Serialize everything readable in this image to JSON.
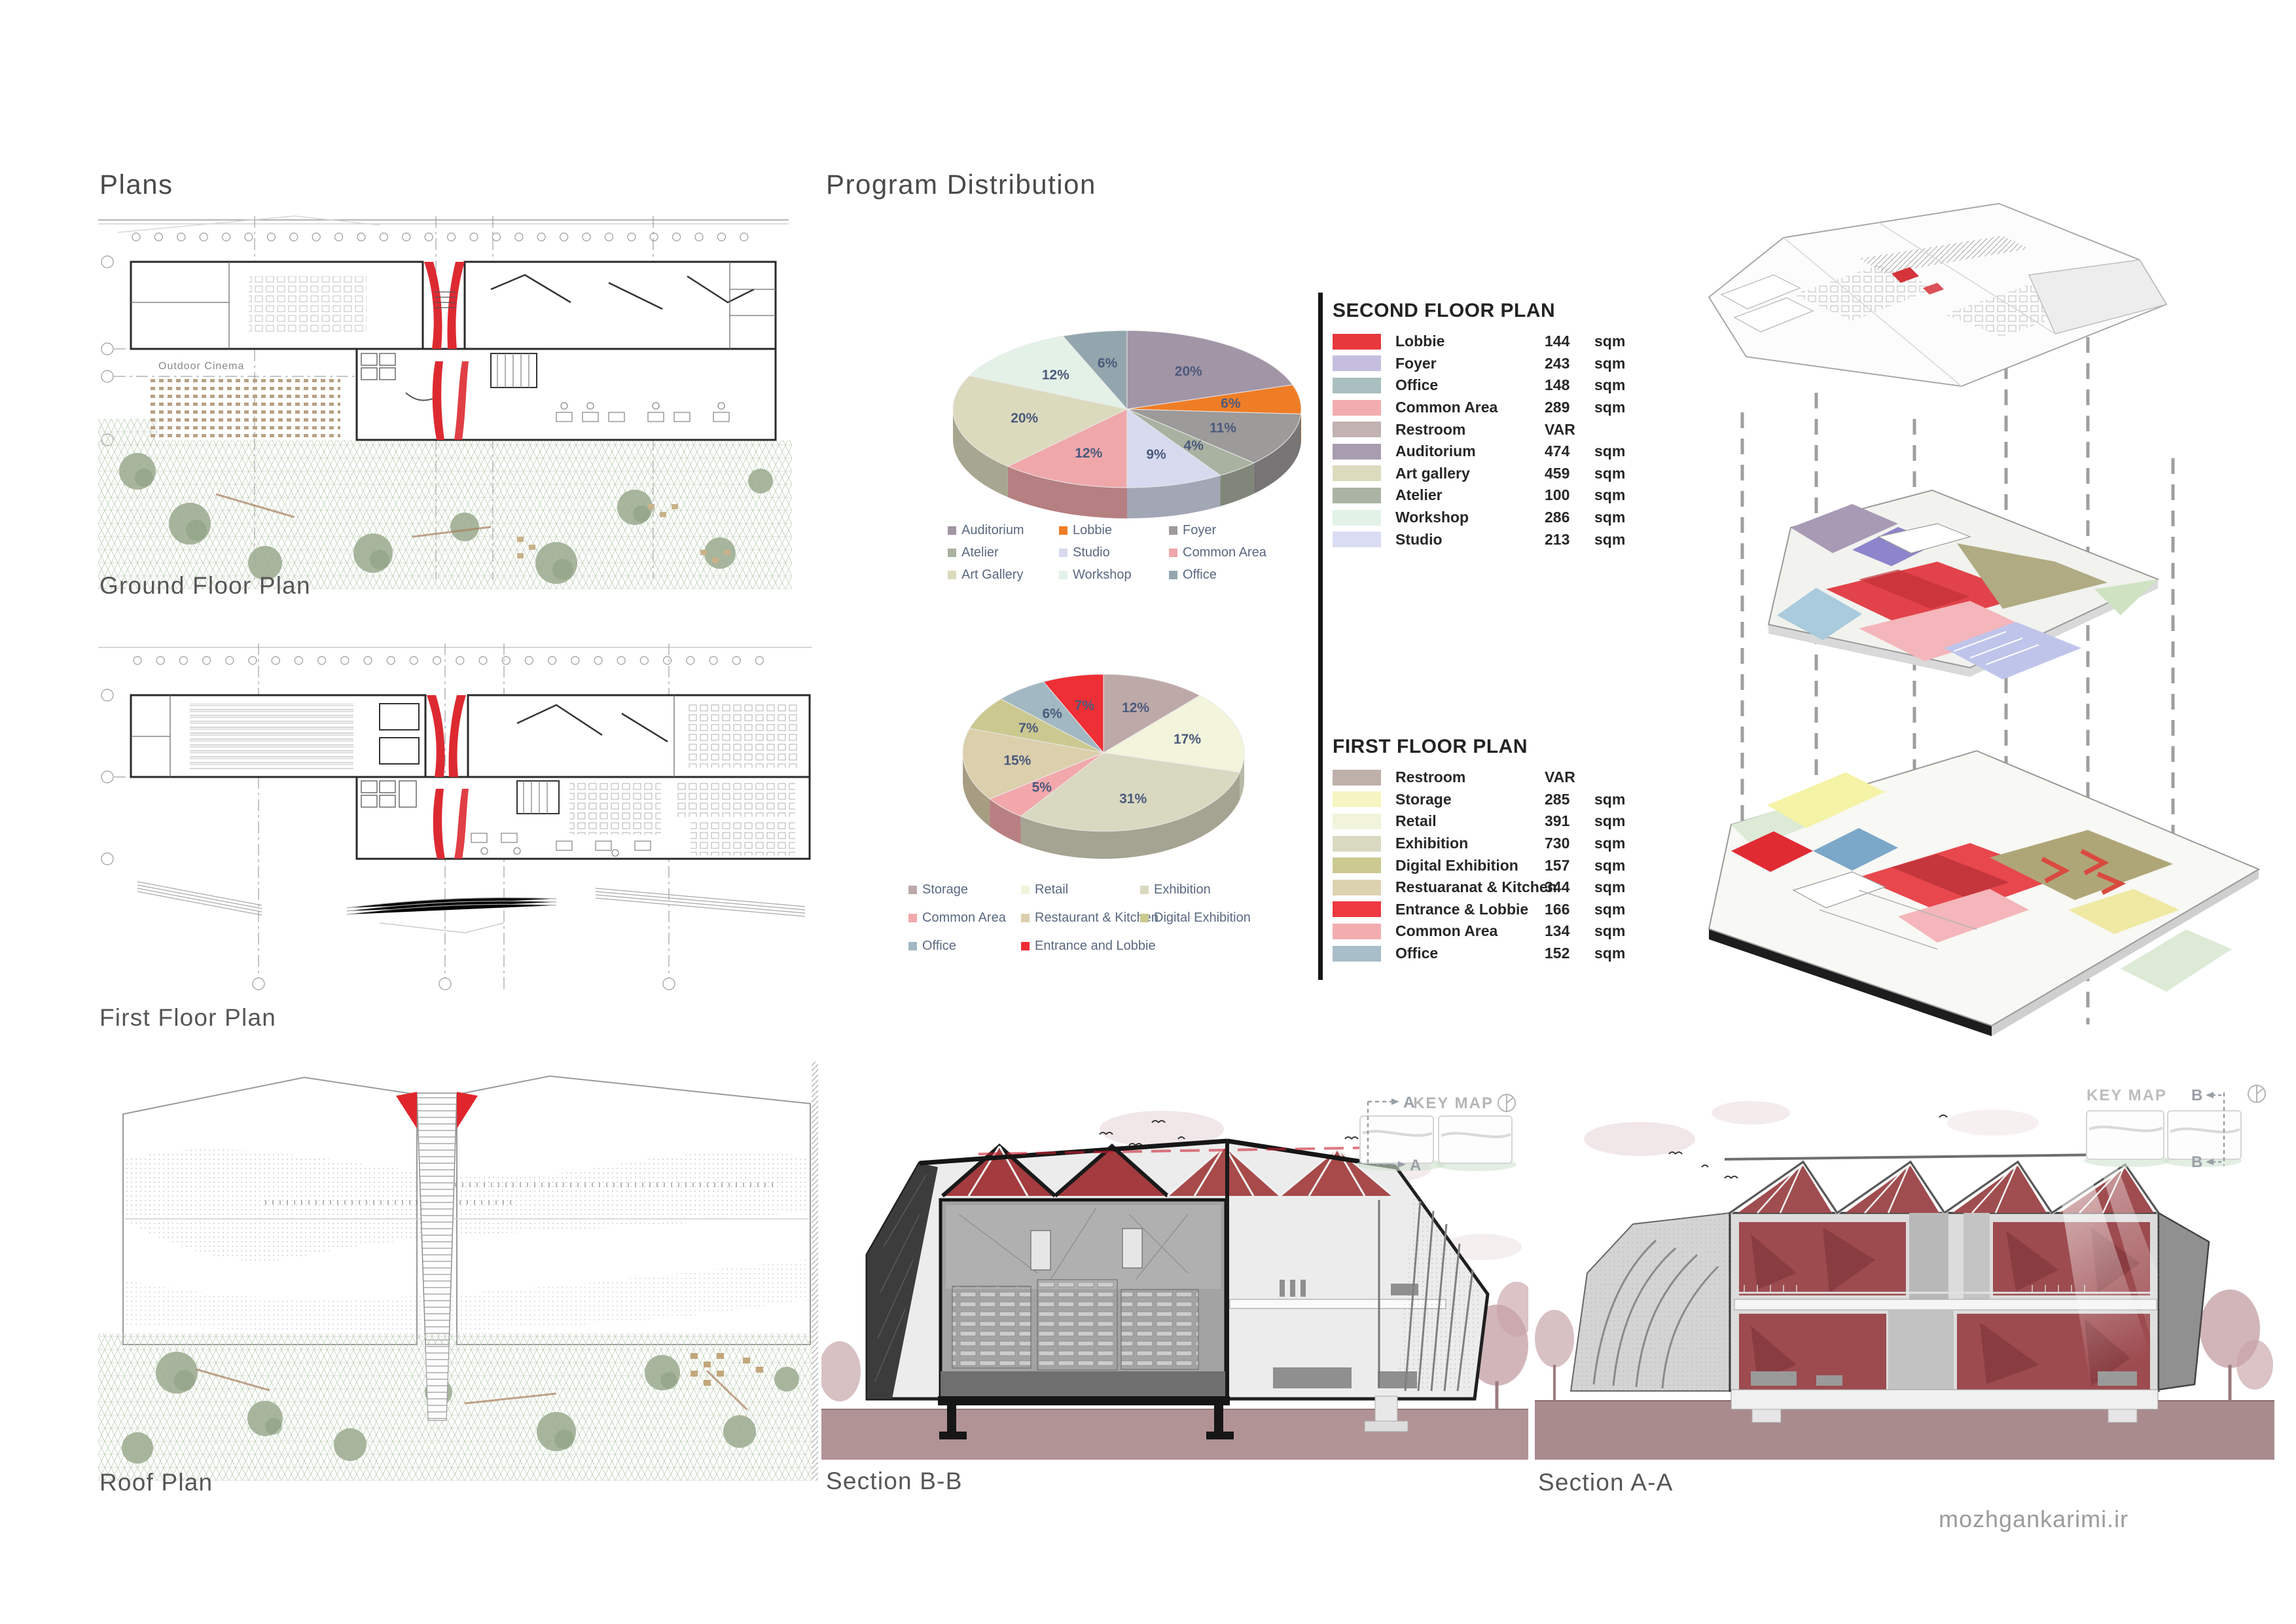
{
  "titles": {
    "plans": "Plans",
    "program": "Program Distribution",
    "watermark": "mozhgankarimi.ir"
  },
  "plan_captions": {
    "ground": "Ground Floor Plan",
    "first": "First Floor Plan",
    "roof": "Roof Plan",
    "outdoor_cinema": "Outdoor Cinema"
  },
  "section_captions": {
    "b": "Section B-B",
    "a": "Section A-A"
  },
  "keymap": {
    "label": "KEY MAP",
    "marker_a": "A",
    "marker_b": "B"
  },
  "program_tables": [
    {
      "title": "SECOND FLOOR PLAN",
      "rows": [
        {
          "label": "Lobbie",
          "area": "144",
          "unit": "sqm",
          "color": "#e7383e"
        },
        {
          "label": "Foyer",
          "area": "243",
          "unit": "sqm",
          "color": "#c6bedf"
        },
        {
          "label": "Office",
          "area": "148",
          "unit": "sqm",
          "color": "#aabfbf"
        },
        {
          "label": "Common Area",
          "area": "289",
          "unit": "sqm",
          "color": "#f3adb0"
        },
        {
          "label": "Restroom",
          "area": "VAR",
          "unit": "",
          "color": "#c2b2b2"
        },
        {
          "label": "Auditorium",
          "area": "474",
          "unit": "sqm",
          "color": "#a89cb0"
        },
        {
          "label": "Art gallery",
          "area": "459",
          "unit": "sqm",
          "color": "#dddbbe"
        },
        {
          "label": "Atelier",
          "area": "100",
          "unit": "sqm",
          "color": "#abb3a4"
        },
        {
          "label": "Workshop",
          "area": "286",
          "unit": "sqm",
          "color": "#e2f2e7"
        },
        {
          "label": "Studio",
          "area": "213",
          "unit": "sqm",
          "color": "#d9dcf3"
        }
      ]
    },
    {
      "title": "FIRST FLOOR PLAN",
      "rows": [
        {
          "label": "Restroom",
          "area": "VAR",
          "unit": "",
          "color": "#bfb0aa"
        },
        {
          "label": "Storage",
          "area": "285",
          "unit": "sqm",
          "color": "#f7f5c1"
        },
        {
          "label": "Retail",
          "area": "391",
          "unit": "sqm",
          "color": "#f1f4db"
        },
        {
          "label": "Exhibition",
          "area": "730",
          "unit": "sqm",
          "color": "#dadac2"
        },
        {
          "label": "Digital Exhibition",
          "area": "157",
          "unit": "sqm",
          "color": "#ccca91"
        },
        {
          "label": "Restuaranat & Kitchen",
          "area": "344",
          "unit": "sqm",
          "color": "#ddd2b0"
        },
        {
          "label": "Entrance & Lobbie",
          "area": "166",
          "unit": "sqm",
          "color": "#ee3a40"
        },
        {
          "label": "Common Area",
          "area": "134",
          "unit": "sqm",
          "color": "#f3adb0"
        },
        {
          "label": "Office",
          "area": "152",
          "unit": "sqm",
          "color": "#a8bec8"
        }
      ]
    }
  ],
  "chart_data": [
    {
      "type": "pie",
      "style": "3d-pie",
      "title": "Second floor program distribution",
      "unit": "percent",
      "start_angle_deg": -90,
      "clockwise": true,
      "legend_columns": 3,
      "label_format": "{value}%",
      "text_color": "#4b5a7d",
      "slices": [
        {
          "label": "Auditorium",
          "value": 20,
          "color": "#a295a6"
        },
        {
          "label": "Lobbie",
          "value": 6,
          "color": "#ef7d26"
        },
        {
          "label": "Foyer",
          "value": 11,
          "color": "#9d9a9a"
        },
        {
          "label": "Atelier",
          "value": 4,
          "color": "#a9b2a1"
        },
        {
          "label": "Studio",
          "value": 9,
          "color": "#d7daee"
        },
        {
          "label": "Common Area",
          "value": 12,
          "color": "#efa7aa"
        },
        {
          "label": "Art Gallery",
          "value": 20,
          "color": "#dcdabd"
        },
        {
          "label": "Workshop",
          "value": 12,
          "color": "#e4f1e7"
        },
        {
          "label": "Office",
          "value": 6,
          "color": "#93a6ad"
        }
      ]
    },
    {
      "type": "pie",
      "style": "3d-pie",
      "title": "First floor program distribution",
      "unit": "percent",
      "start_angle_deg": -90,
      "clockwise": true,
      "legend_columns": 3,
      "label_format": "{value}%",
      "text_color": "#4b5a7d",
      "slices": [
        {
          "label": "Storage",
          "value": 12,
          "color": "#bea9a9"
        },
        {
          "label": "Retail",
          "value": 17,
          "color": "#f2f4db"
        },
        {
          "label": "Exhibition",
          "value": 31,
          "color": "#d9d8c0"
        },
        {
          "label": "Common Area",
          "value": 5,
          "color": "#f2a8ab"
        },
        {
          "label": "Restaurant & Kitchen",
          "value": 15,
          "color": "#dccfac"
        },
        {
          "label": "Digital Exhibition",
          "value": 7,
          "color": "#cbc990"
        },
        {
          "label": "Office",
          "value": 6,
          "color": "#a2b8c2"
        },
        {
          "label": "Entrance and Lobbie",
          "value": 7,
          "color": "#ee2f35"
        }
      ]
    }
  ]
}
